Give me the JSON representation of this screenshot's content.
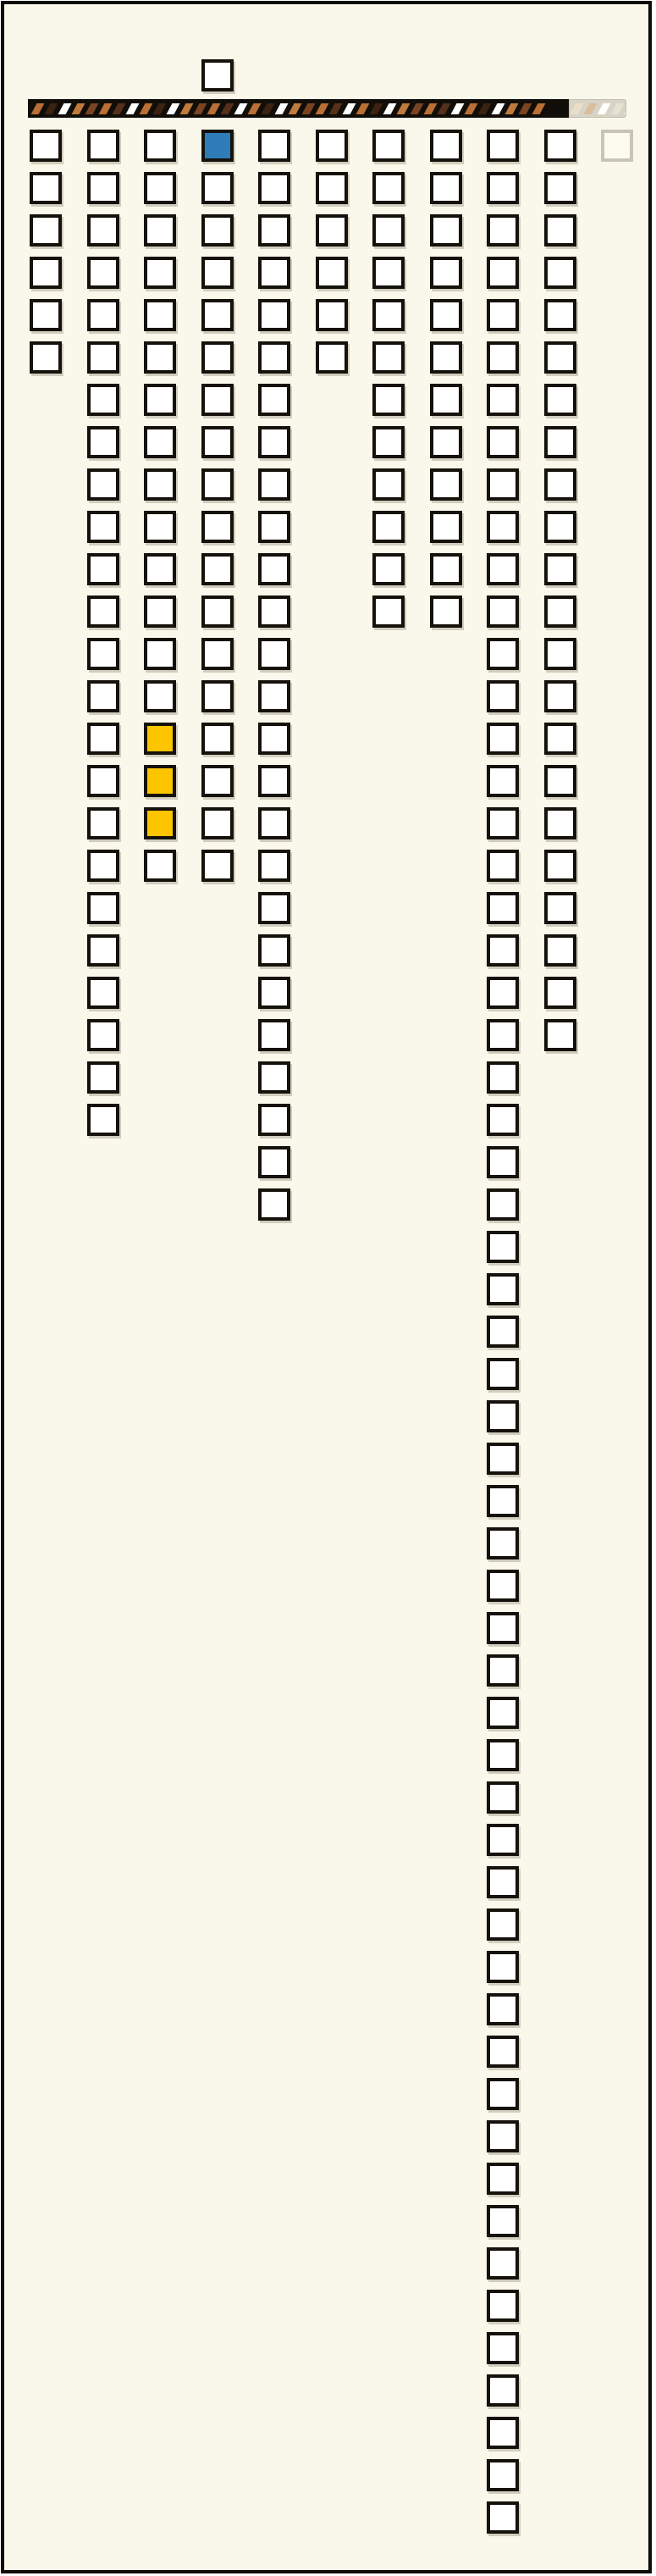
{
  "window": {
    "background_color": "#faf8ea",
    "frame_color": "#0e0c08"
  },
  "palette": {
    "square_fill": "#ffffff",
    "square_border": "#15120c",
    "blue": "#2e7cb8",
    "yellow": "#fdc500",
    "faded_border": "#c9c5b6"
  },
  "striped_bar": {
    "background": "#110e09",
    "stripe_colors": [
      "#b96f35",
      "#3c2210",
      "#ffffff",
      "#c07a3d",
      "#7a4423",
      "#b96f35",
      "#55301a",
      "#ffffff"
    ],
    "active_stripe_count": 38,
    "ghost": {
      "background": "#d7d4c5",
      "stripe_colors": [
        "#eadfca",
        "#d9bd9d",
        "#ffffff",
        "#e6e2d2",
        "#ffffff"
      ],
      "stripe_count": 5
    }
  },
  "lone_square": {
    "column": 4,
    "state": "white"
  },
  "faded_square": {
    "column": 11,
    "row": 1
  },
  "grid": {
    "blue_cell": {
      "column": 4,
      "row": 1
    },
    "columns": [
      {
        "id": 1,
        "length": 6
      },
      {
        "id": 2,
        "length": 24
      },
      {
        "id": 3,
        "length": 18,
        "yellow_rows": [
          15,
          16,
          17
        ]
      },
      {
        "id": 4,
        "length": 18
      },
      {
        "id": 5,
        "length": 26
      },
      {
        "id": 6,
        "length": 6
      },
      {
        "id": 7,
        "length": 12
      },
      {
        "id": 8,
        "length": 12
      },
      {
        "id": 9,
        "length": 57
      },
      {
        "id": 10,
        "length": 22
      }
    ]
  },
  "chart_data": {
    "type": "bar",
    "categories": [
      "col-1",
      "col-2",
      "col-3",
      "col-4",
      "col-5",
      "col-6",
      "col-7",
      "col-8",
      "col-9",
      "col-10"
    ],
    "values": [
      6,
      24,
      18,
      18,
      26,
      6,
      12,
      12,
      57,
      22
    ],
    "title": "",
    "xlabel": "",
    "ylabel": "",
    "annotations": {
      "blue_cell": "column 4, row 1",
      "yellow_cells": "column 3, rows 15-17",
      "faded_cell": "column 11, row 1"
    },
    "legend_position": "none",
    "grid_lines": false
  }
}
